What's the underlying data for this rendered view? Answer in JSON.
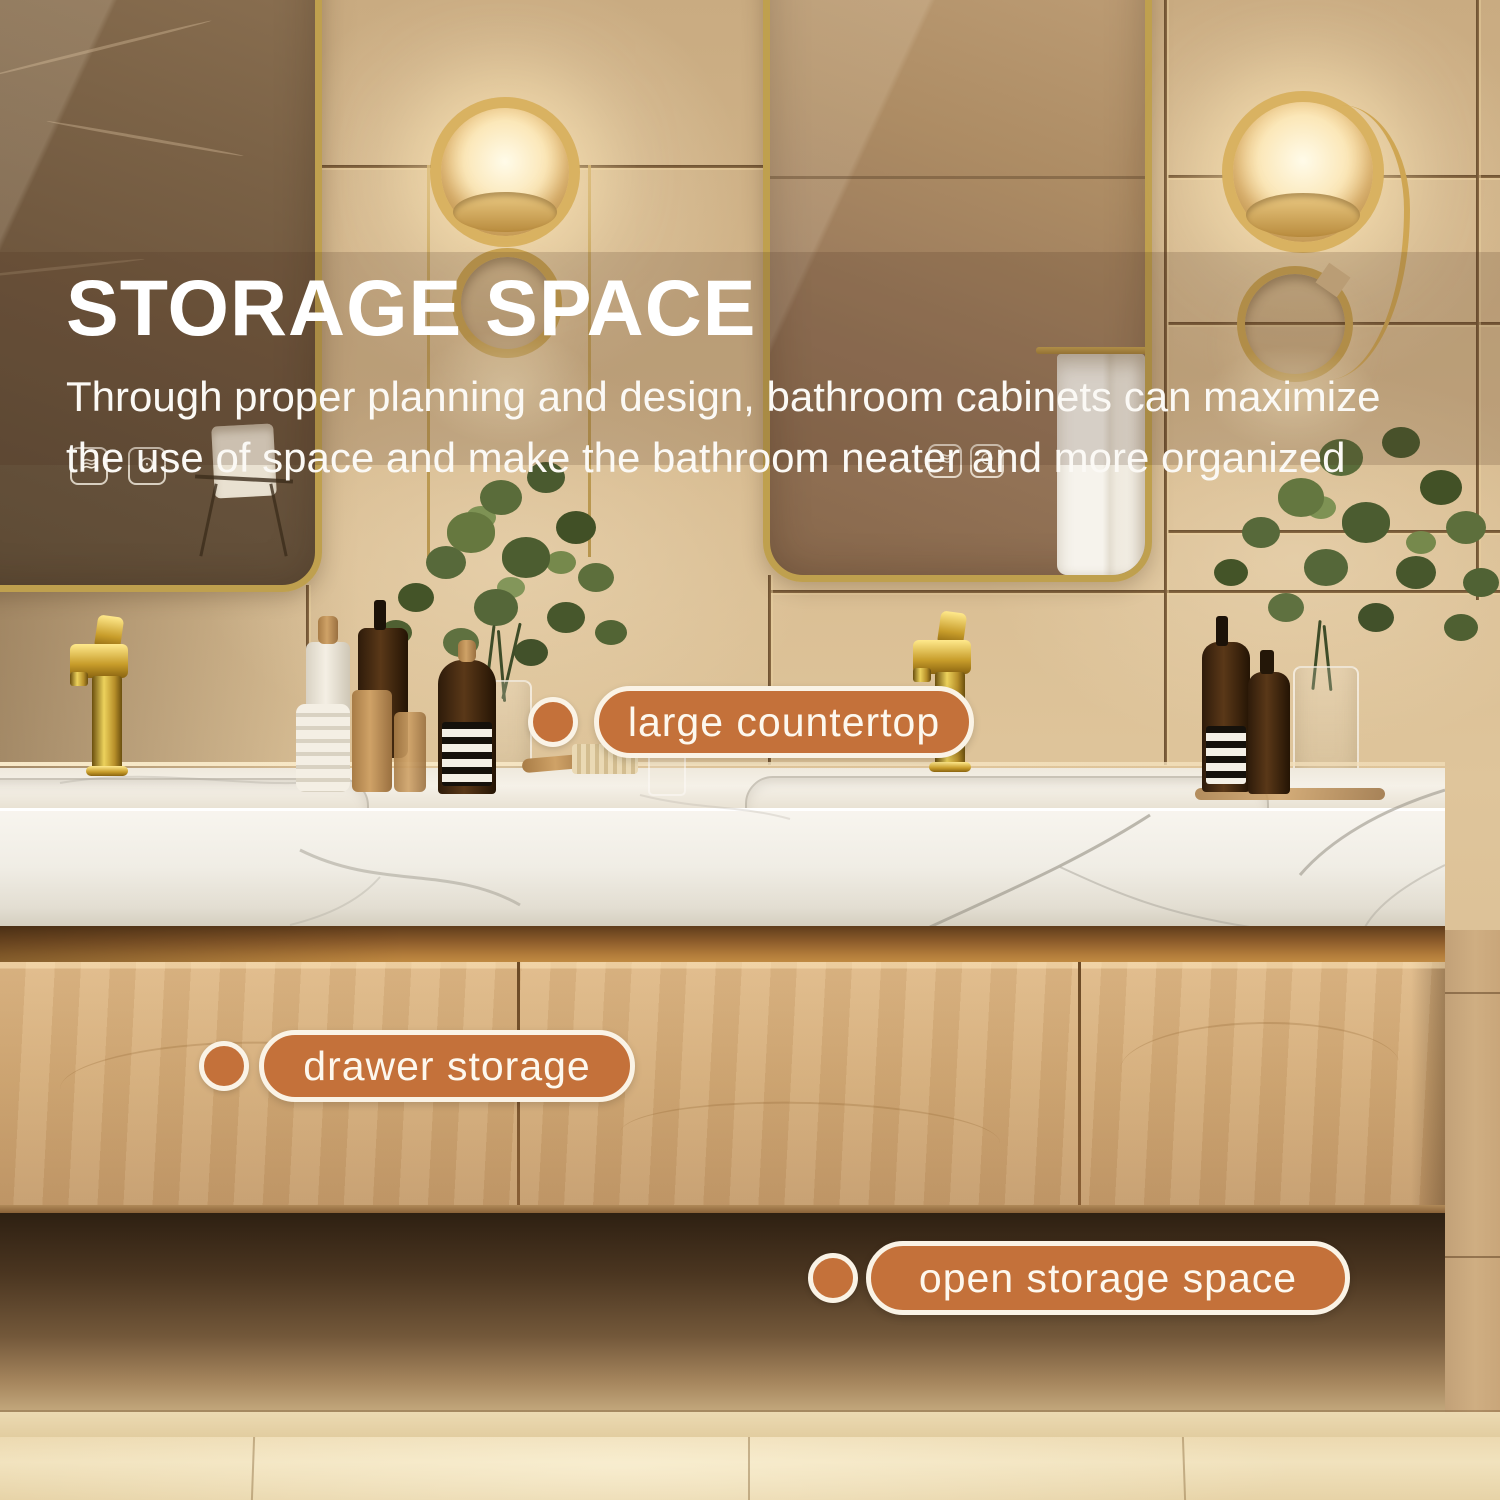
{
  "heading": {
    "title": "STORAGE SPACE",
    "subtitle_lines": [
      "Through proper planning and design, bathroom cabinets can maximize",
      "the use of space and make the bathroom neater and more organized"
    ]
  },
  "callouts": [
    {
      "label": "large countertop"
    },
    {
      "label": "drawer storage"
    },
    {
      "label": "open storage space"
    }
  ],
  "mirror_controls": {
    "defogger_glyph": "≋",
    "light_glyph": "⊙"
  },
  "colors": {
    "accent_orange": "#c4713a",
    "pill_border_cream": "#faf3e6",
    "pill_text_cream": "#fdf8ee",
    "title_white": "#ffffff",
    "gold_frame": "#bfa04e",
    "wall_beige": "#d6ba90",
    "wood_tan": "#d2aa77",
    "marble_white": "#f3f0e9",
    "floor_beige": "#ecd9b0"
  }
}
